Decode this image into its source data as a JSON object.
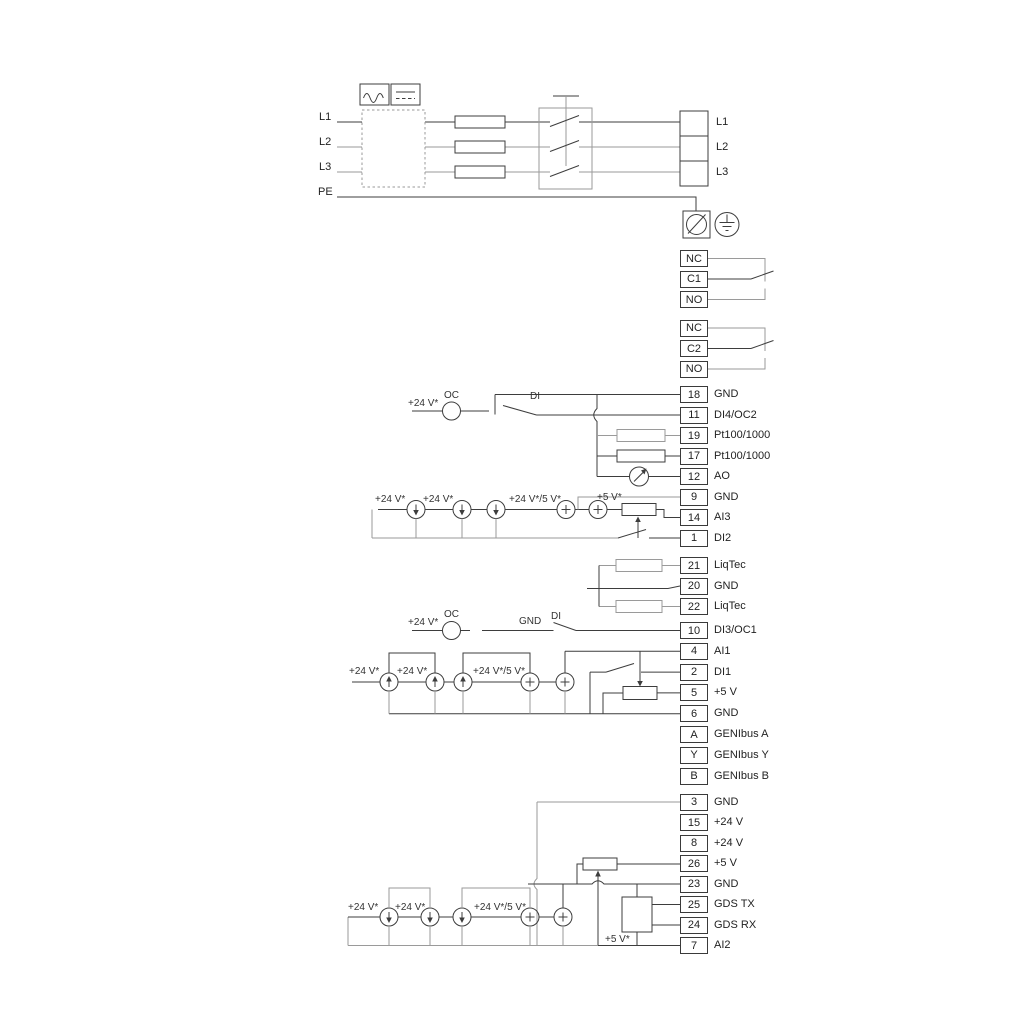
{
  "power": {
    "inputs": [
      "L1",
      "L2",
      "L3",
      "PE"
    ],
    "outputs": [
      "L1",
      "L2",
      "L3"
    ]
  },
  "relay1": [
    {
      "num": "NC"
    },
    {
      "num": "C1"
    },
    {
      "num": "NO"
    }
  ],
  "relay2": [
    {
      "num": "NC"
    },
    {
      "num": "C2"
    },
    {
      "num": "NO"
    }
  ],
  "io_top": [
    {
      "num": "18",
      "label": "GND"
    },
    {
      "num": "11",
      "label": "DI4/OC2"
    },
    {
      "num": "19",
      "label": "Pt100/1000"
    },
    {
      "num": "17",
      "label": "Pt100/1000"
    },
    {
      "num": "12",
      "label": "AO"
    },
    {
      "num": "9",
      "label": "GND"
    },
    {
      "num": "14",
      "label": "AI3"
    },
    {
      "num": "1",
      "label": "DI2"
    }
  ],
  "liqtec": [
    {
      "num": "21",
      "label": "LiqTec"
    },
    {
      "num": "20",
      "label": "GND"
    },
    {
      "num": "22",
      "label": "LiqTec"
    }
  ],
  "io_mid": [
    {
      "num": "10",
      "label": "DI3/OC1"
    },
    {
      "num": "4",
      "label": "AI1"
    },
    {
      "num": "2",
      "label": "DI1"
    },
    {
      "num": "5",
      "label": "+5 V"
    },
    {
      "num": "6",
      "label": "GND"
    },
    {
      "num": "A",
      "label": "GENIbus A"
    },
    {
      "num": "Y",
      "label": "GENIbus Y"
    },
    {
      "num": "B",
      "label": "GENIbus B"
    }
  ],
  "io_bottom": [
    {
      "num": "3",
      "label": "GND"
    },
    {
      "num": "15",
      "label": "+24 V"
    },
    {
      "num": "8",
      "label": "+24 V"
    },
    {
      "num": "26",
      "label": "+5 V"
    },
    {
      "num": "23",
      "label": "GND"
    },
    {
      "num": "25",
      "label": "GDS TX"
    },
    {
      "num": "24",
      "label": "GDS RX"
    },
    {
      "num": "7",
      "label": "AI2"
    }
  ],
  "ann": {
    "oc_top_supply": "+24 V*",
    "oc_top": "OC",
    "di_top": "DI",
    "ai3_s1": "+24 V*",
    "ai3_s2": "+24 V*",
    "ai3_s3": "+24 V*/5 V*",
    "ai3_s4": "+5 V*",
    "oc_mid_supply": "+24 V*",
    "oc_mid": "OC",
    "gnd_mid": "GND",
    "di_mid": "DI",
    "ai1_s1": "+24 V*",
    "ai1_s2": "+24 V*",
    "ai1_s3": "+24 V*/5 V*",
    "ai2_s1": "+24 V*",
    "ai2_s2": "+24 V*",
    "ai2_s3": "+24 V*/5 V*",
    "ai2_s4": "+5 V*"
  },
  "colors": {
    "wire_dark": "#3d3d3d",
    "wire_light": "#9a9a9a",
    "text": "#222222"
  }
}
